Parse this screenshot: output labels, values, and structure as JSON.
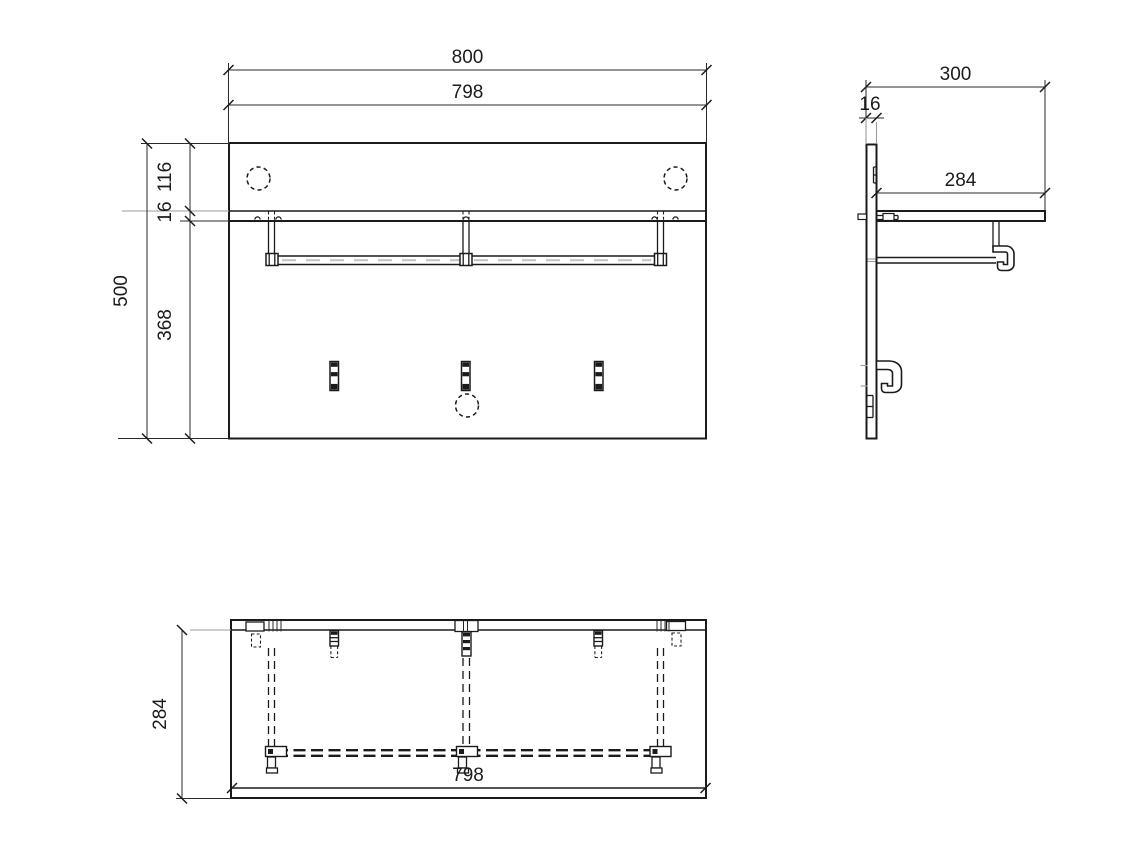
{
  "drawing": {
    "type": "technical-orthographic-drawing",
    "subject": "wall-mounted coat rack panel with shelf, hanging rail and three hooks",
    "colors": {
      "object_line": "#1b1b1b",
      "dimension_line": "#2a2a2a",
      "extension_line_gray": "#9b9b9b",
      "background": "#ffffff"
    },
    "views": {
      "front": {
        "label": "front view",
        "dims": {
          "overall_width": "800",
          "body_width": "798",
          "overall_height": "500",
          "top_to_shelf": "116",
          "shelf_thickness": "16",
          "below_shelf": "368"
        }
      },
      "side": {
        "label": "side view",
        "dims": {
          "overall_depth": "300",
          "panel_thickness": "16",
          "shelf_depth": "284"
        }
      },
      "bottom": {
        "label": "bottom view",
        "dims": {
          "depth": "284",
          "width": "798"
        }
      }
    }
  }
}
